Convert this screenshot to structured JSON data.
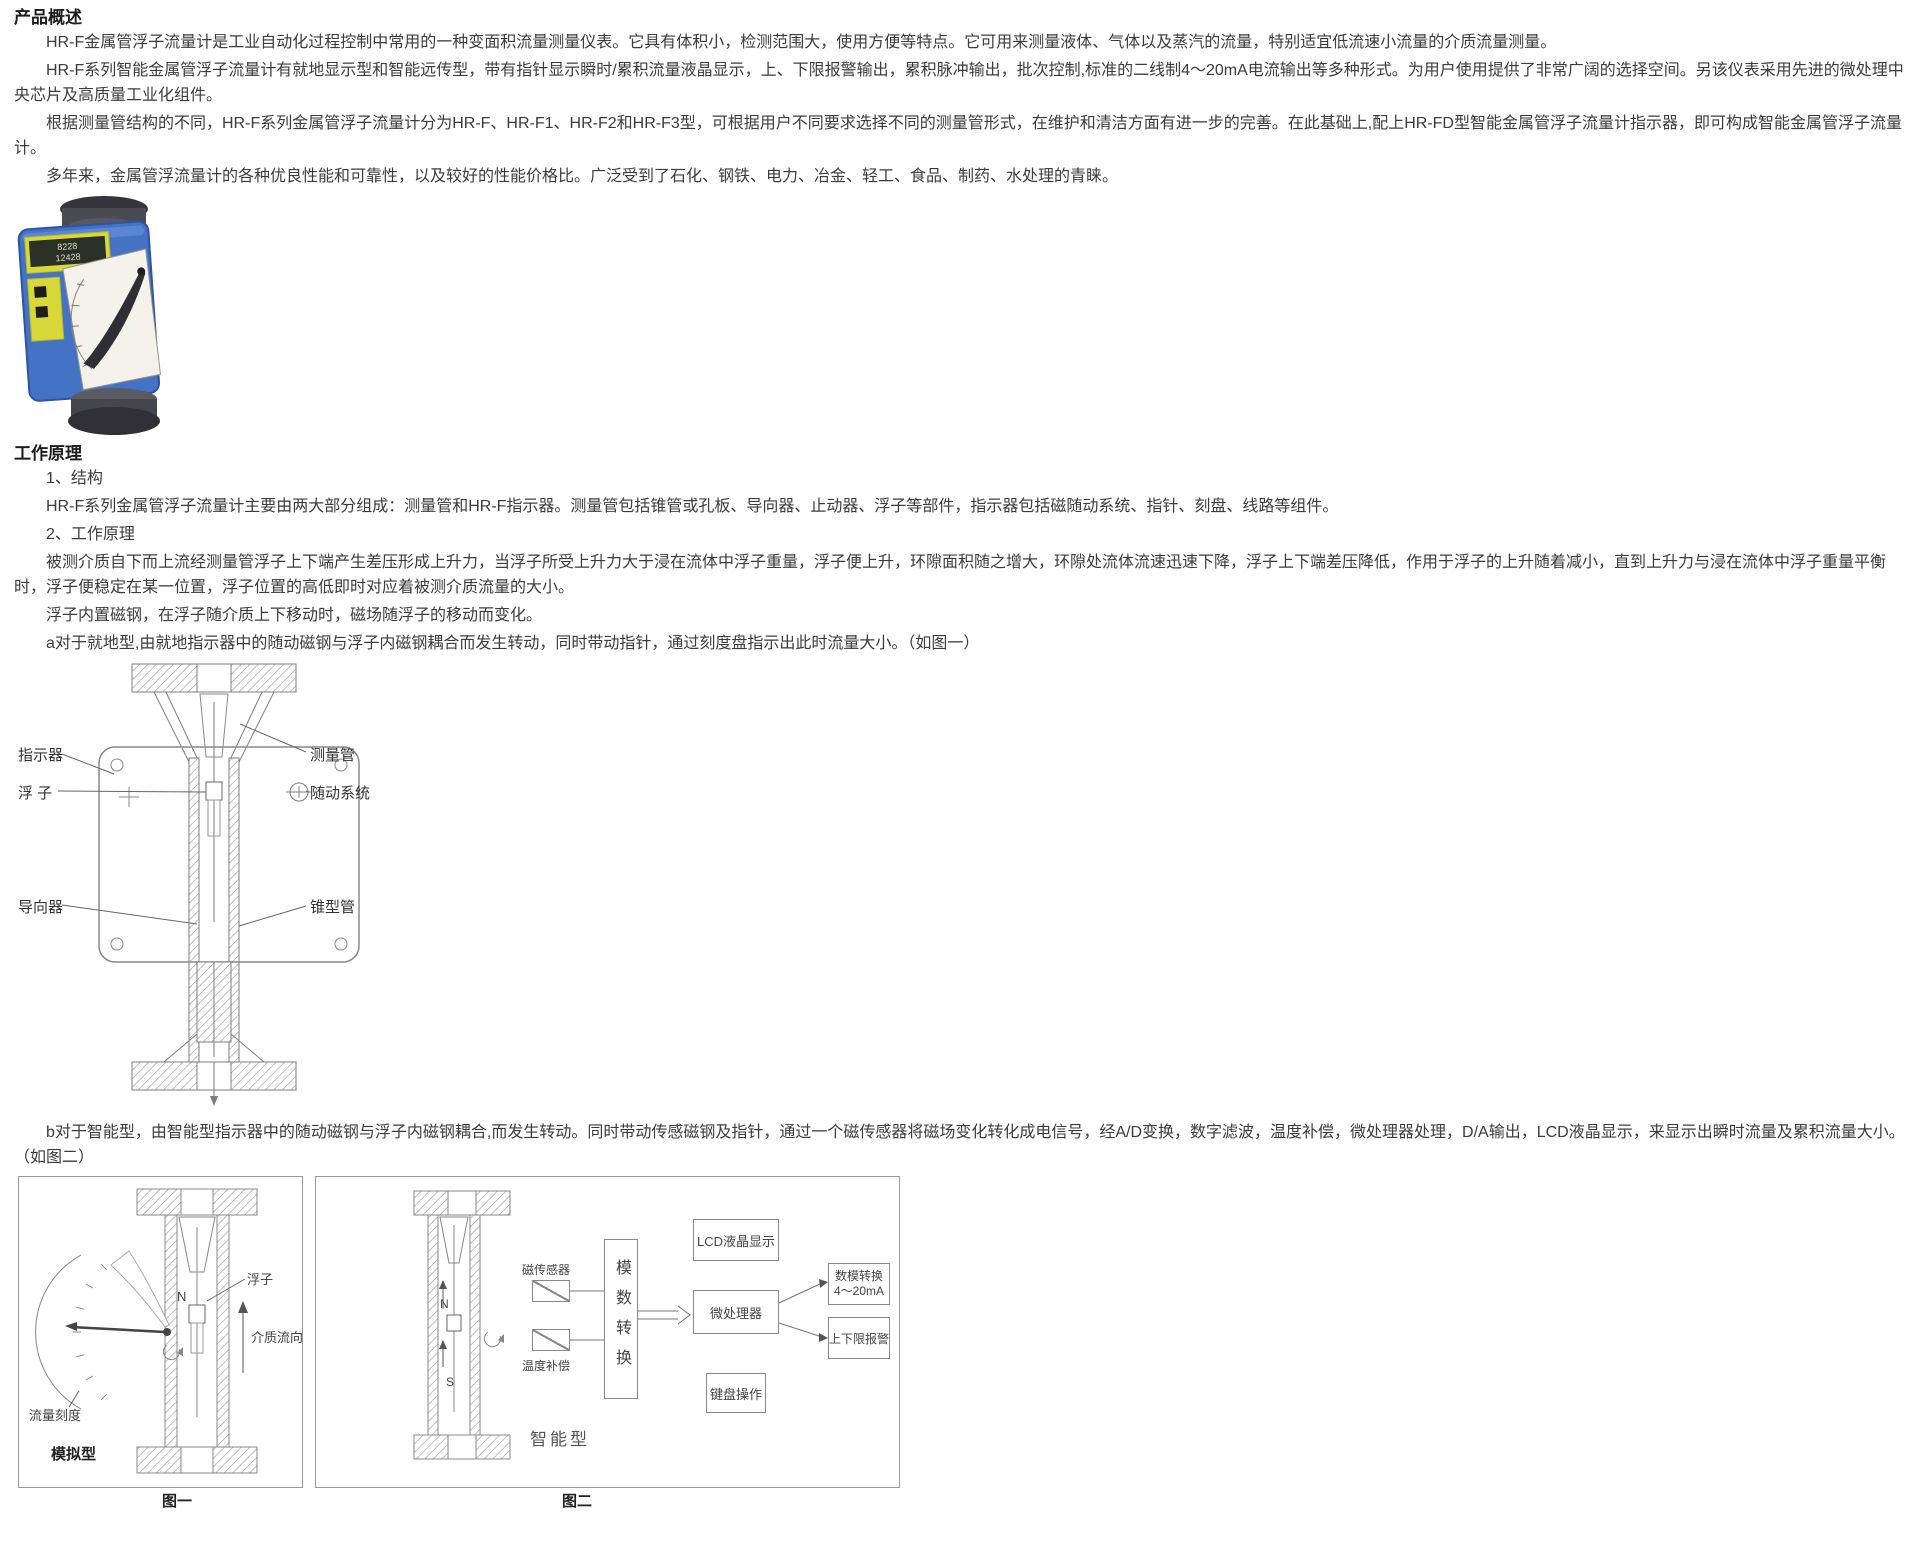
{
  "overview": {
    "heading": "产品概述",
    "p1": "HR-F金属管浮子流量计是工业自动化过程控制中常用的一种变面积流量测量仪表。它具有体积小，检测范围大，使用方便等特点。它可用来测量液体、气体以及蒸汽的流量，特别适宜低流速小流量的介质流量测量。",
    "p2": "HR-F系列智能金属管浮子流量计有就地显示型和智能远传型，带有指针显示瞬时/累积流量液晶显示，上、下限报警输出，累积脉冲输出，批次控制,标准的二线制4～20mA电流输出等多种形式。为用户使用提供了非常广阔的选择空间。另该仪表采用先进的微处理中央芯片及高质量工业化组件。",
    "p3": "根据测量管结构的不同，HR-F系列金属管浮子流量计分为HR-F、HR-F1、HR-F2和HR-F3型，可根据用户不同要求选择不同的测量管形式，在维护和清洁方面有进一步的完善。在此基础上,配上HR-FD型智能金属管浮子流量计指示器，即可构成智能金属管浮子流量计。",
    "p4": "多年来，金属管浮流量计的各种优良性能和可靠性，以及较好的性能价格比。广泛受到了石化、钢铁、电力、冶金、轻工、食品、制药、水处理的青睐。"
  },
  "product_photo": {
    "lcd_line1": "8228",
    "lcd_line2": "12428"
  },
  "principle": {
    "heading": "工作原理",
    "item1_title": "1、结构",
    "item1_text": "HR-F系列金属管浮子流量计主要由两大部分组成：测量管和HR-F指示器。测量管包括锥管或孔板、导向器、止动器、浮子等部件，指示器包括磁随动系统、指针、刻盘、线路等组件。",
    "item2_title": "2、工作原理",
    "item2_text": "被测介质自下而上流经测量管浮子上下端产生差压形成上升力，当浮子所受上升力大于浸在流体中浮子重量，浮子便上升，环隙面积随之增大，环隙处流体流速迅速下降，浮子上下端差压降低，作用于浮子的上升随着减小，直到上升力与浸在流体中浮子重量平衡时，浮子便稳定在某一位置，浮子位置的高低即时对应着被测介质流量的大小。",
    "magnet_text": "浮子内置磁钢，在浮子随介质上下移动时，磁场随浮子的移动而变化。",
    "local_type_text": "a对于就地型,由就地指示器中的随动磁钢与浮子内磁钢耦合而发生转动，同时带动指针，通过刻度盘指示出此时流量大小。（如图一）",
    "smart_type_text": "b对于智能型，由智能型指示器中的随动磁钢与浮子内磁钢耦合,而发生转动。同时带动传感磁钢及指针，通过一个磁传感器将磁场变化转化成电信号，经A/D变换，数字滤波，温度补偿，微处理器处理，D/A输出，LCD液晶显示，来显示出瞬时流量及累积流量大小。（如图二）"
  },
  "structure_diagram": {
    "indicator": "指示器",
    "float": "浮 子",
    "guide": "导向器",
    "measuring_tube": "测量管",
    "follower_system": "随动系统",
    "cone_tube": "锥型管"
  },
  "figure1": {
    "float_label": "浮子",
    "flow_direction_label": "介质流向",
    "scale_label": "流量刻度",
    "type_label": "模拟型",
    "n_label": "N",
    "caption": "图一"
  },
  "figure2": {
    "magnetic_sensor": "磁传感器",
    "temperature_compensation": "温度补偿",
    "ad_converter": "模数转换",
    "lcd_display": "LCD液晶显示",
    "microprocessor": "微处理器",
    "da_output_line1": "数模转换",
    "da_output_line2": "4～20mA",
    "limit_alarm": "上下限报警",
    "keyboard": "键盘操作",
    "type_label": "智能型",
    "n_label": "N",
    "s_label": "S",
    "caption": "图二"
  }
}
